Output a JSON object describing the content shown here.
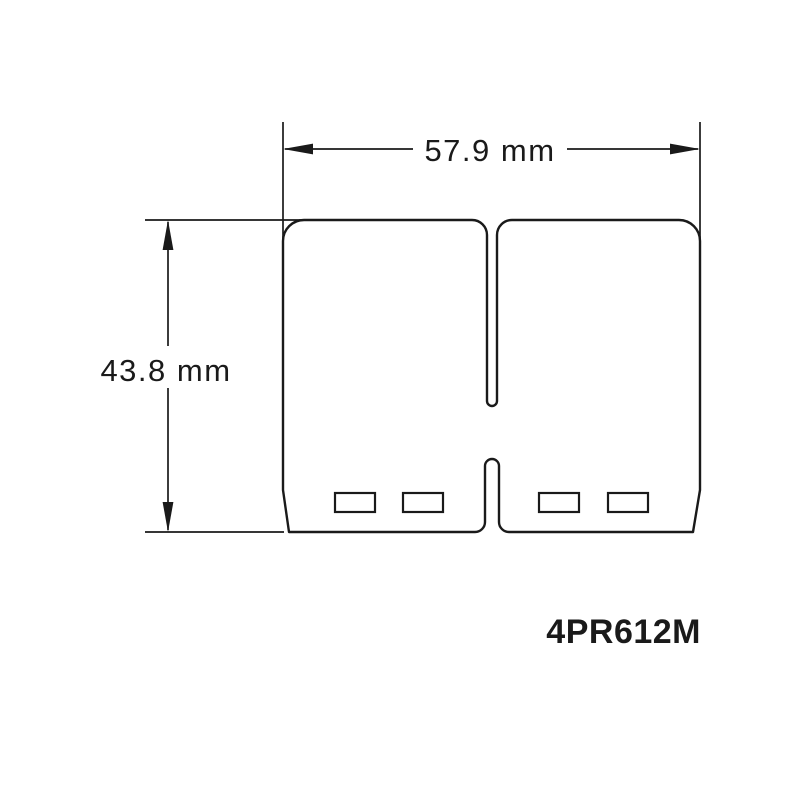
{
  "drawing": {
    "part_number": "4PR612M",
    "dimensions": {
      "width": {
        "label": "57.9 mm",
        "value": 57.9,
        "unit": "mm"
      },
      "height": {
        "label": "43.8 mm",
        "value": 43.8,
        "unit": "mm"
      }
    },
    "colors": {
      "line": "#1a1a1a",
      "background": "#ffffff"
    }
  }
}
